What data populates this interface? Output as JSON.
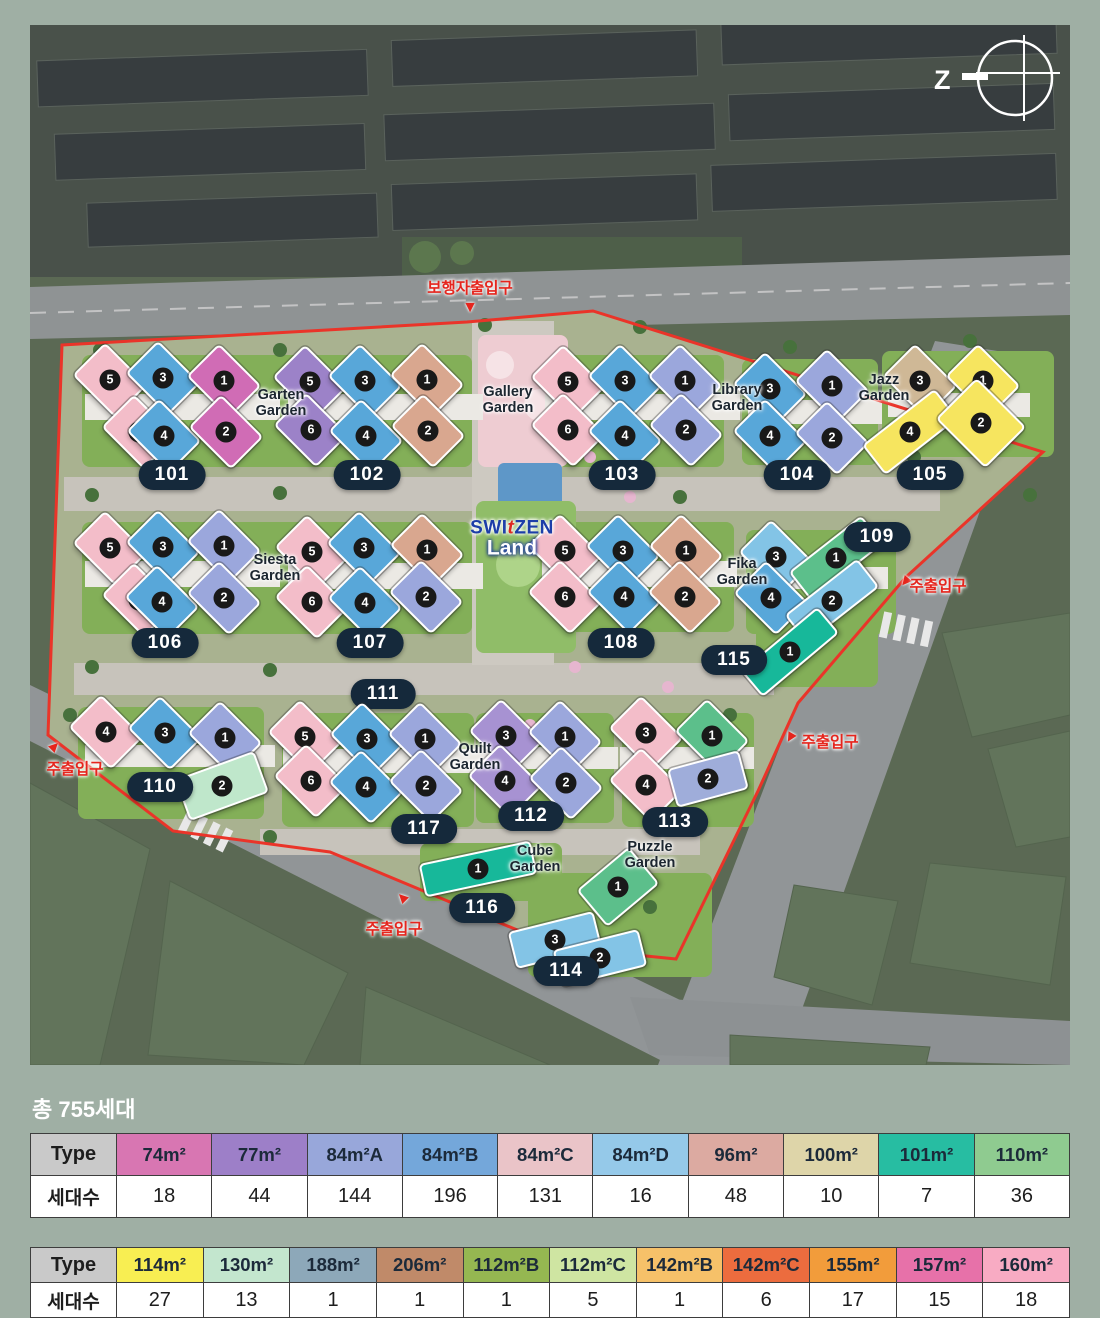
{
  "heading": {
    "total": "총 755세대"
  },
  "map": {
    "compass": {
      "letter": "Z"
    },
    "logo": {
      "x": 482,
      "y": 514,
      "part1": "SWI",
      "part2": "t",
      "part3": "ZEN",
      "line2": "Land"
    },
    "colors": {
      "pink": "#f3bdc9",
      "blue": "#58a7d9",
      "magenta": "#d06cb5",
      "purple": "#9c82c8",
      "tan": "#d9a78f",
      "peri": "#9ba7dc",
      "yellow": "#f6e55f",
      "khaki": "#cfb896",
      "lblue": "#83c4e6",
      "green": "#5cbf8b",
      "mint": "#bfe7cb",
      "teal": "#17b89a",
      "slate": "#9fadda",
      "lilac": "#a792d2"
    },
    "boundary_color": "#ea3429",
    "gardens": [
      {
        "name": "Garten Garden",
        "x": 251,
        "y": 378
      },
      {
        "name": "Gallery Garden",
        "x": 478,
        "y": 375
      },
      {
        "name": "Library Garden",
        "x": 707,
        "y": 373
      },
      {
        "name": "Jazz Garden",
        "x": 854,
        "y": 363
      },
      {
        "name": "Siesta Garden",
        "x": 245,
        "y": 543
      },
      {
        "name": "Fika Garden",
        "x": 712,
        "y": 547
      },
      {
        "name": "Quilt Garden",
        "x": 445,
        "y": 732
      },
      {
        "name": "Cube Garden",
        "x": 505,
        "y": 834
      },
      {
        "name": "Puzzle Garden",
        "x": 620,
        "y": 830
      }
    ],
    "entrances": [
      {
        "label": "보행자출입구",
        "tx": 440,
        "ty": 262,
        "ax": 440,
        "ay": 283,
        "rot": 0
      },
      {
        "label": "주출입구",
        "tx": 908,
        "ty": 560,
        "ax": 875,
        "ay": 557,
        "rot": 40
      },
      {
        "label": "주출입구",
        "tx": 800,
        "ty": 716,
        "ax": 760,
        "ay": 713,
        "rot": 30
      },
      {
        "label": "주출입구",
        "tx": 45,
        "ty": 743,
        "ax": 25,
        "ay": 721,
        "rot": 225
      },
      {
        "label": "주출입구",
        "tx": 364,
        "ty": 903,
        "ax": 372,
        "ay": 872,
        "rot": 135
      }
    ],
    "blocks": [
      {
        "id": "101",
        "lx": 142,
        "ly": 450,
        "buildings": [
          {
            "n": "5",
            "x": 80,
            "y": 355,
            "c": "pink"
          },
          {
            "n": "3",
            "x": 133,
            "y": 353,
            "c": "blue"
          },
          {
            "n": "1",
            "x": 194,
            "y": 356,
            "c": "magenta"
          },
          {
            "n": "6",
            "x": 109,
            "y": 407,
            "c": "pink"
          },
          {
            "n": "4",
            "x": 134,
            "y": 411,
            "c": "blue"
          },
          {
            "n": "2",
            "x": 196,
            "y": 407,
            "c": "magenta"
          }
        ]
      },
      {
        "id": "102",
        "lx": 337,
        "ly": 450,
        "buildings": [
          {
            "n": "5",
            "x": 280,
            "y": 357,
            "c": "purple"
          },
          {
            "n": "3",
            "x": 335,
            "y": 356,
            "c": "blue"
          },
          {
            "n": "1",
            "x": 397,
            "y": 355,
            "c": "tan"
          },
          {
            "n": "6",
            "x": 281,
            "y": 405,
            "c": "purple"
          },
          {
            "n": "4",
            "x": 336,
            "y": 411,
            "c": "blue"
          },
          {
            "n": "2",
            "x": 398,
            "y": 406,
            "c": "tan"
          }
        ]
      },
      {
        "id": "103",
        "lx": 592,
        "ly": 450,
        "buildings": [
          {
            "n": "5",
            "x": 538,
            "y": 357,
            "c": "pink"
          },
          {
            "n": "3",
            "x": 595,
            "y": 356,
            "c": "blue"
          },
          {
            "n": "1",
            "x": 655,
            "y": 356,
            "c": "peri"
          },
          {
            "n": "6",
            "x": 538,
            "y": 405,
            "c": "pink"
          },
          {
            "n": "4",
            "x": 595,
            "y": 411,
            "c": "blue"
          },
          {
            "n": "2",
            "x": 656,
            "y": 405,
            "c": "peri"
          }
        ]
      },
      {
        "id": "104",
        "lx": 767,
        "ly": 450,
        "buildings": [
          {
            "n": "3",
            "x": 740,
            "y": 364,
            "c": "blue"
          },
          {
            "n": "1",
            "x": 802,
            "y": 361,
            "c": "peri"
          },
          {
            "n": "4",
            "x": 740,
            "y": 411,
            "c": "blue"
          },
          {
            "n": "2",
            "x": 802,
            "y": 413,
            "c": "peri"
          }
        ]
      },
      {
        "id": "105",
        "lx": 900,
        "ly": 450,
        "buildings": [
          {
            "n": "3",
            "x": 890,
            "y": 356,
            "c": "khaki"
          },
          {
            "n": "1",
            "x": 953,
            "y": 356,
            "c": "yellow"
          },
          {
            "n": "4",
            "x": 880,
            "y": 407,
            "c": "yellow",
            "w": 88,
            "h": 34,
            "r": -38
          },
          {
            "n": "2",
            "x": 951,
            "y": 398,
            "c": "yellow",
            "w": 66,
            "h": 54
          }
        ]
      },
      {
        "id": "106",
        "lx": 135,
        "ly": 618,
        "buildings": [
          {
            "n": "5",
            "x": 80,
            "y": 523,
            "c": "pink"
          },
          {
            "n": "3",
            "x": 133,
            "y": 522,
            "c": "blue"
          },
          {
            "n": "1",
            "x": 194,
            "y": 521,
            "c": "peri"
          },
          {
            "n": "6",
            "x": 109,
            "y": 575,
            "c": "pink"
          },
          {
            "n": "4",
            "x": 132,
            "y": 577,
            "c": "blue"
          },
          {
            "n": "2",
            "x": 194,
            "y": 573,
            "c": "peri"
          }
        ]
      },
      {
        "id": "107",
        "lx": 340,
        "ly": 618,
        "buildings": [
          {
            "n": "5",
            "x": 282,
            "y": 527,
            "c": "pink"
          },
          {
            "n": "3",
            "x": 334,
            "y": 523,
            "c": "blue"
          },
          {
            "n": "1",
            "x": 397,
            "y": 525,
            "c": "tan"
          },
          {
            "n": "6",
            "x": 282,
            "y": 577,
            "c": "pink"
          },
          {
            "n": "4",
            "x": 335,
            "y": 578,
            "c": "blue"
          },
          {
            "n": "2",
            "x": 396,
            "y": 572,
            "c": "peri"
          }
        ]
      },
      {
        "id": "108",
        "lx": 591,
        "ly": 618,
        "buildings": [
          {
            "n": "5",
            "x": 535,
            "y": 526,
            "c": "pink"
          },
          {
            "n": "3",
            "x": 593,
            "y": 526,
            "c": "blue"
          },
          {
            "n": "1",
            "x": 656,
            "y": 526,
            "c": "tan"
          },
          {
            "n": "6",
            "x": 535,
            "y": 572,
            "c": "pink"
          },
          {
            "n": "4",
            "x": 594,
            "y": 572,
            "c": "blue"
          },
          {
            "n": "2",
            "x": 655,
            "y": 572,
            "c": "tan"
          }
        ]
      },
      {
        "id": "109",
        "lx": 847,
        "ly": 512,
        "buildings": [
          {
            "n": "3",
            "x": 746,
            "y": 532,
            "c": "lblue"
          },
          {
            "n": "1",
            "x": 806,
            "y": 533,
            "c": "green",
            "w": 88,
            "h": 32,
            "r": -38
          },
          {
            "n": "4",
            "x": 741,
            "y": 573,
            "c": "blue"
          },
          {
            "n": "2",
            "x": 802,
            "y": 576,
            "c": "lblue",
            "w": 88,
            "h": 32,
            "r": -38
          }
        ]
      },
      {
        "id": "115",
        "lx": 704,
        "ly": 635,
        "buildings": [
          {
            "n": "1",
            "x": 760,
            "y": 627,
            "c": "teal",
            "w": 96,
            "h": 30,
            "r": -40
          }
        ]
      },
      {
        "id": "111",
        "lx": 353,
        "ly": 669,
        "buildings": []
      },
      {
        "id": "110",
        "lx": 130,
        "ly": 762,
        "buildings": [
          {
            "n": "4",
            "x": 76,
            "y": 707,
            "c": "pink"
          },
          {
            "n": "3",
            "x": 135,
            "y": 708,
            "c": "blue"
          },
          {
            "n": "1",
            "x": 195,
            "y": 713,
            "c": "peri"
          },
          {
            "n": "2",
            "x": 192,
            "y": 761,
            "c": "mint",
            "w": 80,
            "h": 40,
            "r": -20
          }
        ]
      },
      {
        "id": "117",
        "lx": 394,
        "ly": 804,
        "buildings": [
          {
            "n": "5",
            "x": 275,
            "y": 712,
            "c": "pink"
          },
          {
            "n": "3",
            "x": 337,
            "y": 714,
            "c": "blue"
          },
          {
            "n": "1",
            "x": 395,
            "y": 714,
            "c": "peri"
          },
          {
            "n": "6",
            "x": 281,
            "y": 756,
            "c": "pink"
          },
          {
            "n": "4",
            "x": 336,
            "y": 762,
            "c": "blue"
          },
          {
            "n": "2",
            "x": 396,
            "y": 761,
            "c": "peri"
          }
        ]
      },
      {
        "id": "112",
        "lx": 501,
        "ly": 791,
        "buildings": [
          {
            "n": "3",
            "x": 476,
            "y": 711,
            "c": "lilac"
          },
          {
            "n": "1",
            "x": 535,
            "y": 712,
            "c": "peri"
          },
          {
            "n": "4",
            "x": 475,
            "y": 756,
            "c": "lilac"
          },
          {
            "n": "2",
            "x": 536,
            "y": 758,
            "c": "peri"
          }
        ]
      },
      {
        "id": "113",
        "lx": 645,
        "ly": 797,
        "buildings": [
          {
            "n": "3",
            "x": 616,
            "y": 708,
            "c": "pink"
          },
          {
            "n": "1",
            "x": 682,
            "y": 711,
            "c": "green"
          },
          {
            "n": "4",
            "x": 616,
            "y": 760,
            "c": "pink"
          },
          {
            "n": "2",
            "x": 678,
            "y": 754,
            "c": "slate",
            "w": 70,
            "h": 36,
            "r": -15
          }
        ]
      },
      {
        "id": "116",
        "lx": 452,
        "ly": 883,
        "buildings": [
          {
            "n": "1",
            "x": 448,
            "y": 844,
            "c": "teal",
            "w": 110,
            "h": 30,
            "r": -12
          }
        ]
      },
      {
        "id": "114",
        "lx": 536,
        "ly": 946,
        "buildings": [
          {
            "n": "1",
            "x": 588,
            "y": 862,
            "c": "green",
            "w": 64,
            "h": 44,
            "r": -40
          },
          {
            "n": "3",
            "x": 525,
            "y": 915,
            "c": "lblue",
            "w": 84,
            "h": 34,
            "r": -14
          },
          {
            "n": "2",
            "x": 570,
            "y": 933,
            "c": "lblue",
            "w": 84,
            "h": 34,
            "r": -14
          }
        ]
      }
    ]
  },
  "tables": [
    {
      "header": "Type",
      "row_header": "세대수",
      "columns": [
        {
          "label": "74m²",
          "value": "18",
          "color": "#d876b2"
        },
        {
          "label": "77m²",
          "value": "44",
          "color": "#9d7fc8"
        },
        {
          "label": "84m²A",
          "value": "144",
          "color": "#98a7da"
        },
        {
          "label": "84m²B",
          "value": "196",
          "color": "#74a7da"
        },
        {
          "label": "84m²C",
          "value": "131",
          "color": "#eac4c8"
        },
        {
          "label": "84m²D",
          "value": "16",
          "color": "#95c9e9"
        },
        {
          "label": "96m²",
          "value": "48",
          "color": "#dcaaa1"
        },
        {
          "label": "100m²",
          "value": "10",
          "color": "#ded5a9"
        },
        {
          "label": "101m²",
          "value": "7",
          "color": "#27bda2"
        },
        {
          "label": "110m²",
          "value": "36",
          "color": "#8fcb90"
        }
      ]
    },
    {
      "header": "Type",
      "row_header": "세대수",
      "columns": [
        {
          "label": "114m²",
          "value": "27",
          "color": "#f8ee52"
        },
        {
          "label": "130m²",
          "value": "13",
          "color": "#c3e6ce"
        },
        {
          "label": "188m²",
          "value": "1",
          "color": "#8da8b9"
        },
        {
          "label": "206m²",
          "value": "1",
          "color": "#c08a69"
        },
        {
          "label": "112m²B",
          "value": "1",
          "color": "#95b751"
        },
        {
          "label": "112m²C",
          "value": "5",
          "color": "#cfe5a2"
        },
        {
          "label": "142m²B",
          "value": "1",
          "color": "#f6c169"
        },
        {
          "label": "142m²C",
          "value": "6",
          "color": "#ec6c3e"
        },
        {
          "label": "155m²",
          "value": "17",
          "color": "#f29c3b"
        },
        {
          "label": "157m²",
          "value": "15",
          "color": "#e771a9"
        },
        {
          "label": "160m²",
          "value": "18",
          "color": "#f8abc3"
        }
      ]
    }
  ]
}
